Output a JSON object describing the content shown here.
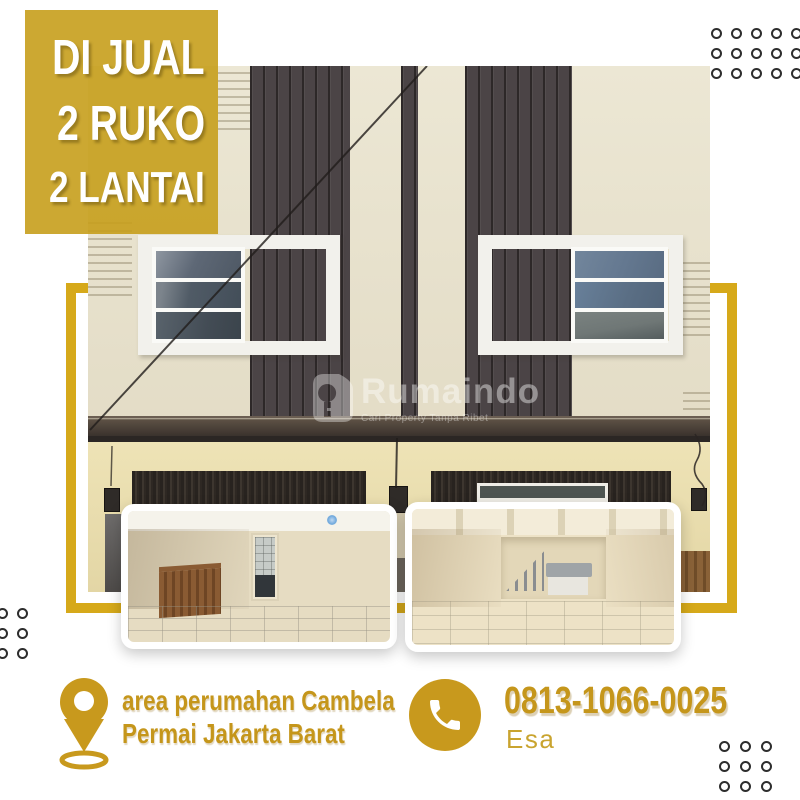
{
  "poster": {
    "badge": {
      "lines": [
        "DI JUAL",
        "2 RUKO",
        "2 LANTAI"
      ]
    },
    "watermark": {
      "brand": "Rumaindo",
      "tagline": "Cari Property Tanpa Ribet",
      "logo_icon": "house-key-icon"
    },
    "location": {
      "icon": "map-pin-icon",
      "line1": "area perumahan Cambela",
      "line2": "Permai Jakarta Barat"
    },
    "contact": {
      "icon": "phone-icon",
      "phone": "0813-1066-0025",
      "name": "Esa"
    },
    "photos": {
      "main": "two-storey shophouse facade with dark panel bands and white framed windows",
      "inset_left": "empty interior room with rear doorway and wooden railing",
      "inset_right": "empty interior room with staircase and counter"
    },
    "colors": {
      "gold_text": "#C5961B",
      "badge_gold": "#C79E1C",
      "frame_gold": "#D6A91A",
      "dark_panel": "#4B4446",
      "facade_cream": "#EBE6D3",
      "dot_ring": "#2D2D2D"
    },
    "decor": {
      "dots": "circle-grid"
    }
  }
}
